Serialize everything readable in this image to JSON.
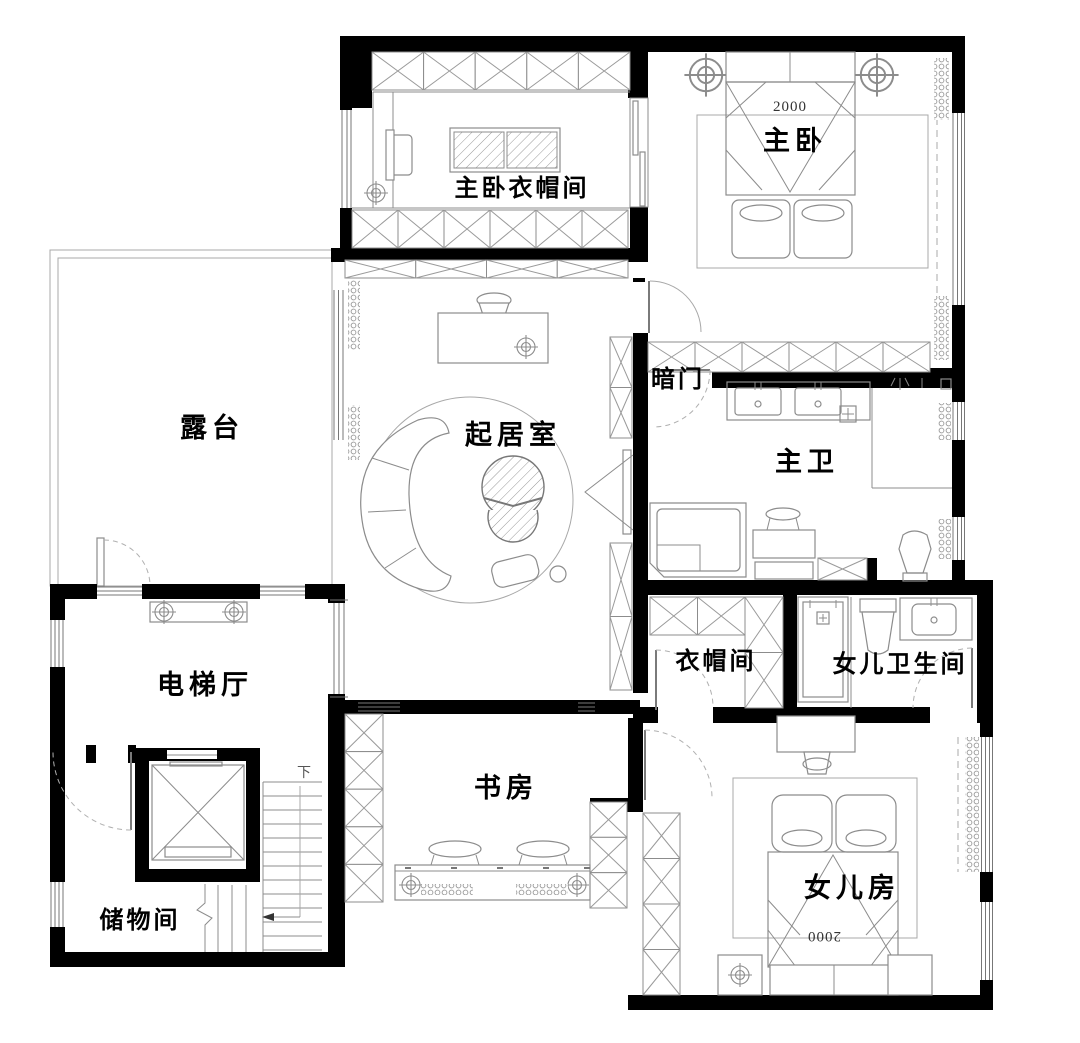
{
  "floor_plan": {
    "rooms": {
      "master_closet": {
        "label": "主卧衣帽间"
      },
      "master_bedroom": {
        "label": "主卧"
      },
      "terrace": {
        "label": "露台"
      },
      "living_room": {
        "label": "起居室"
      },
      "hidden_door": {
        "label": "暗门"
      },
      "master_bath": {
        "label": "主卫"
      },
      "elevator_hall": {
        "label": "电梯厅"
      },
      "closet": {
        "label": "衣帽间"
      },
      "daughter_bath": {
        "label": "女儿卫生间"
      },
      "study": {
        "label": "书房"
      },
      "daughter_room": {
        "label": "女儿房"
      },
      "storage": {
        "label": "储物间"
      }
    },
    "annotations": {
      "master_bed_width": "2000",
      "daughter_bed_width": "2000",
      "stairs_down": "下"
    },
    "colors": {
      "wall": "#000000",
      "drawing_line": "#8c8c8c",
      "label": "#000000",
      "background": "#ffffff"
    }
  }
}
